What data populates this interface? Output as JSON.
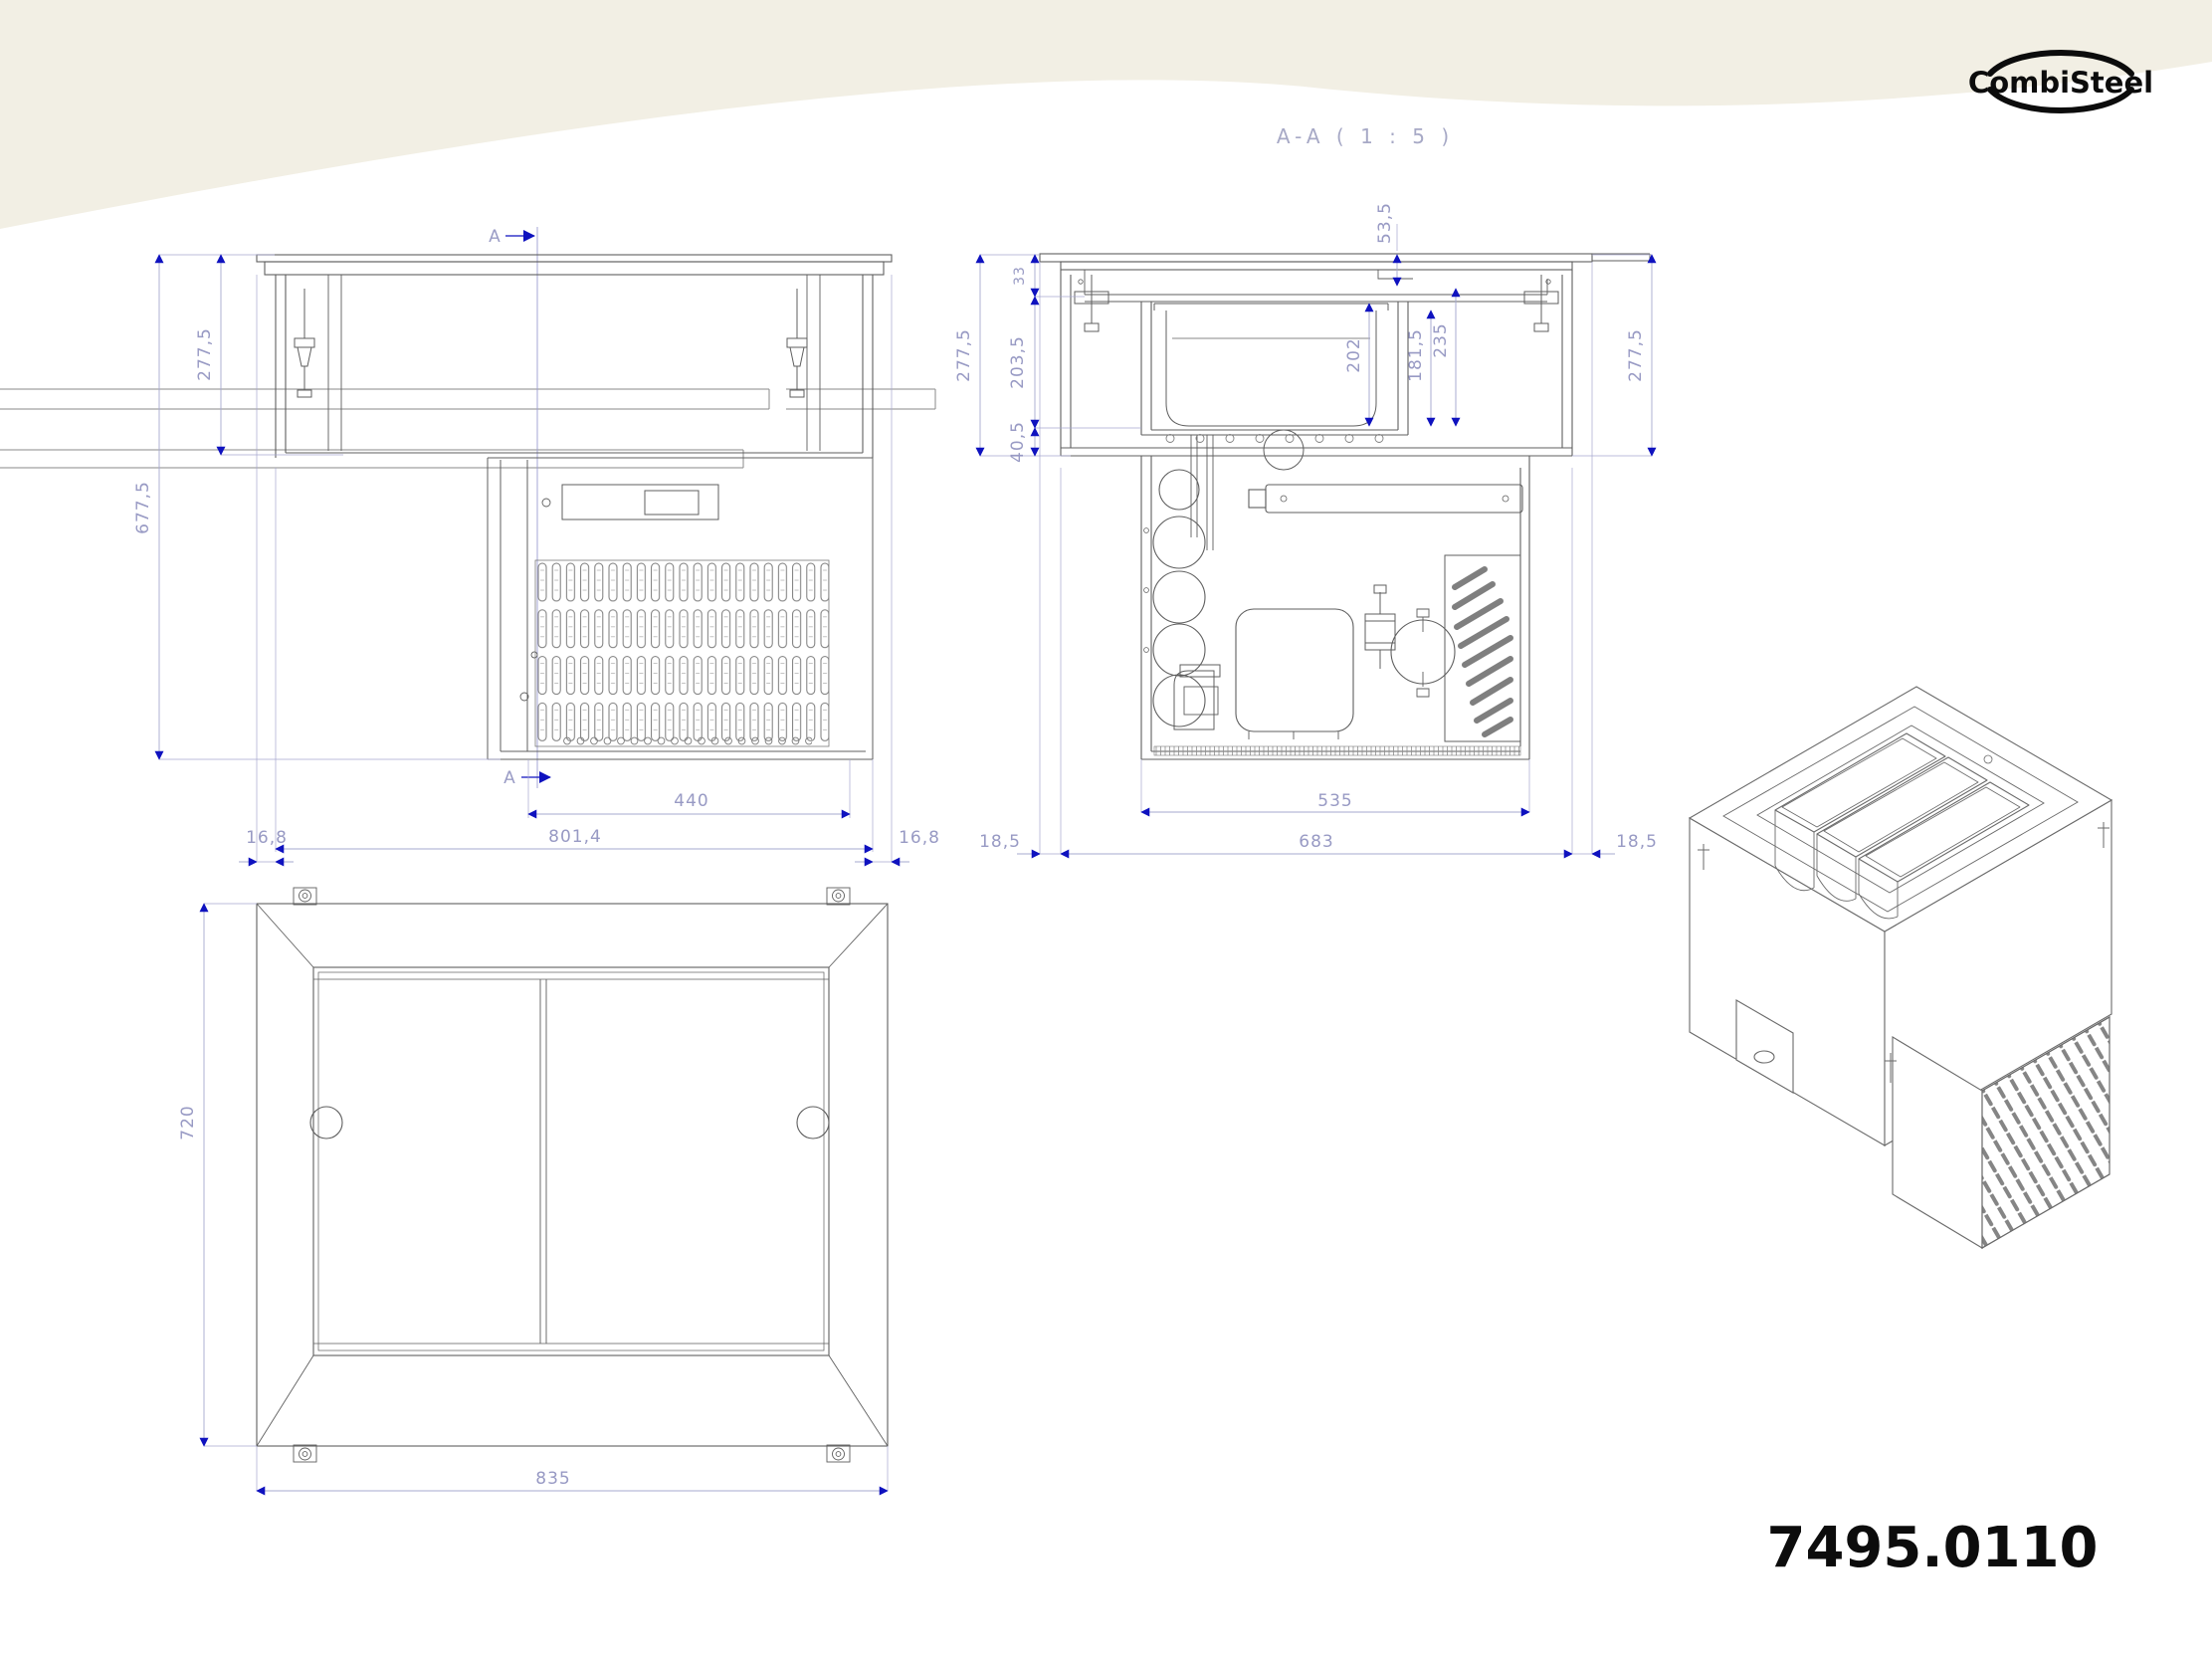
{
  "branding": {
    "logo_text": "CombiSteel",
    "product_code": "7495.0110"
  },
  "front_view": {
    "marker_top": "A",
    "marker_bottom": "A",
    "dims": {
      "flange_height": "277,5",
      "total_height": "677,5",
      "vent_width": "440",
      "body_width": "801,4",
      "flange_left": "16,8",
      "flange_right": "16,8"
    }
  },
  "section_view": {
    "title": "A-A ( 1 : 5 )",
    "dims": {
      "counter_step": "33",
      "mid_height": "203,5",
      "bottom_step": "40,5",
      "left_total": "277,5",
      "flange_step": "53,5",
      "pan_depth": "202",
      "pan_inner_depth": "181,5",
      "well_depth": "235",
      "right_total": "277,5",
      "machine_width": "535",
      "body_depth": "683",
      "flange_left": "18,5",
      "flange_right": "18,5"
    }
  },
  "plan_view": {
    "dims": {
      "depth": "720",
      "width": "835"
    }
  }
}
